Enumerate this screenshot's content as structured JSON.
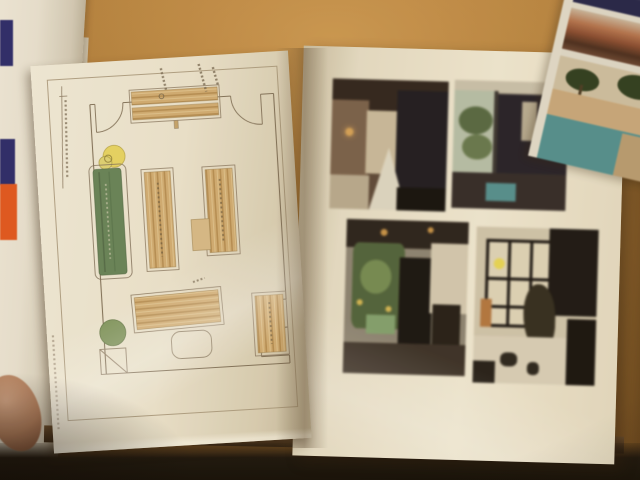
{
  "scene": {
    "description": "Photograph of an open ring binder lying on a wooden table: the left page holds a hand-drawn furniture floor plan, the right page holds four interior photographs in a two-by-two grid; a white envelope and a fingertip appear at the left edge and the corner of a travel magazine at the top right",
    "left_page": {
      "description": "Hand-drawn cafe floor plan with wood-grain counters and shelves, a green bench with a yellow round stove, a green round table, door swing arcs and illegible handwritten notes"
    },
    "right_page": {
      "description": "Four slightly rotated interior photographs of a cafe arranged two by two",
      "photos": [
        "Dark interior view with wooden ceiling, cream wall and a white triangular lamp shade",
        "Interior with bright planted window on the left and dark furniture silhouettes",
        "Cafe room with hanging plants, yellow fruit, dark counter and white wall with chair",
        "Black-framed glass partition wall with plant silhouette and a small yellow sticker dot"
      ]
    },
    "magazine": {
      "description": "Corner of a travel magazine showing a dark navy masthead, a resort roof photo and a palm-tree pool photo"
    },
    "envelope": {
      "description": "White envelope with navy and orange printed patches and faint vertical blue lettering"
    },
    "hand": {
      "description": "Fingertip holding the stack of pages at the left edge"
    },
    "table": {
      "description": "Warm caramel-brown wooden table surface, dark shadow along the bottom"
    }
  },
  "colors": {
    "table": "#a97837",
    "page": "#eae2cd",
    "plan_line": "#8a7963",
    "wood": "#cfa96e",
    "green_furniture": "#5f7d52",
    "yellow_marker": "#e6d35e",
    "green_marker": "#7a9159",
    "sticker_yellow": "#e8d44a",
    "envelope_navy": "#2b2a6a",
    "envelope_orange": "#e0561e",
    "magazine_navy": "#23234a",
    "pool_teal": "#4f8f8f",
    "binder_edge": "#4a3420",
    "shadow_dark": "#1a130c",
    "skin": "#b07c5c"
  }
}
